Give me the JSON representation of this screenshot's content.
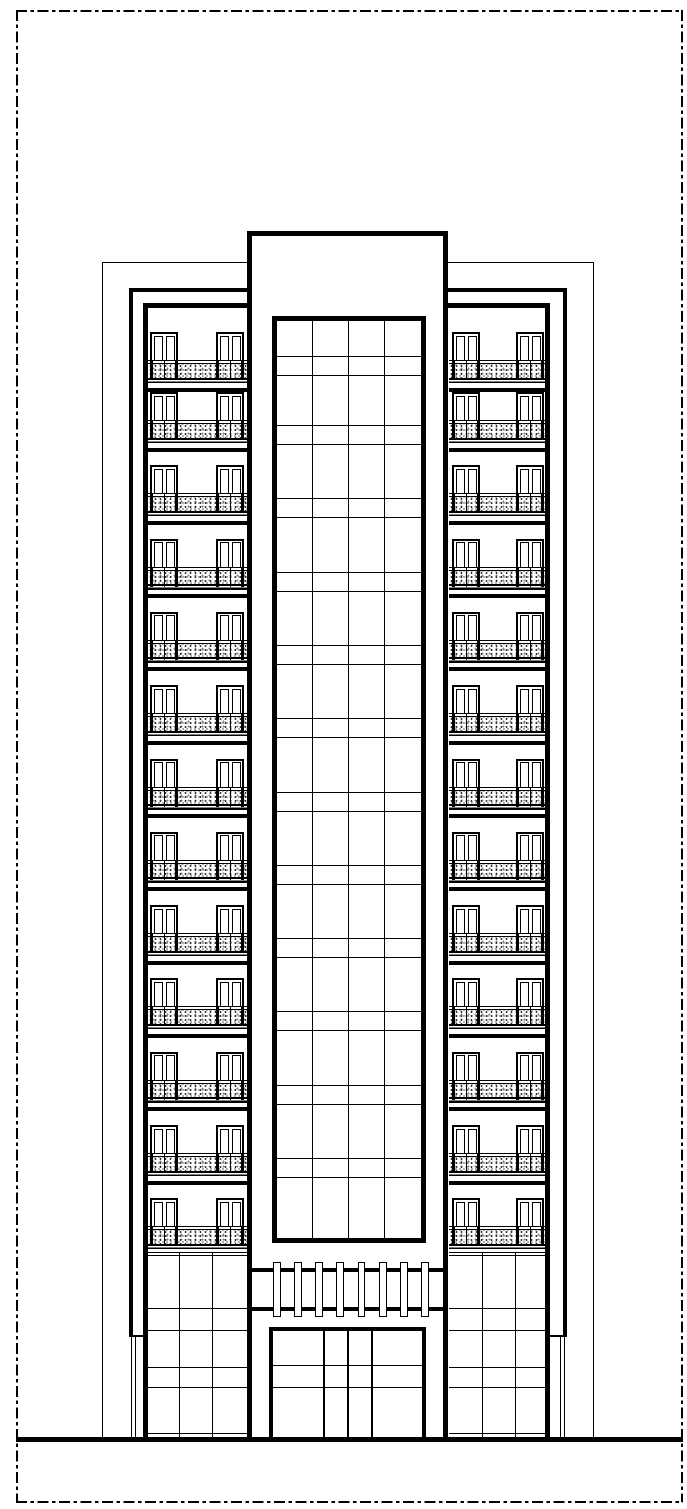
{
  "sheet": {
    "kind": "architectural-elevation-drawing",
    "background": "#ffffff",
    "line_color": "#000000",
    "border_style": "dash-dot"
  },
  "building": {
    "floors": 13,
    "wings": [
      {
        "side": "left",
        "windows_per_floor": 2
      },
      {
        "side": "right",
        "windows_per_floor": 2
      }
    ],
    "window": {
      "leaves": 2
    },
    "balcony": {
      "texture": "stipple",
      "bold_posts": 4,
      "thin_posts": 2
    },
    "curtain_wall": {
      "columns": 4,
      "spandrel_bands": 12
    },
    "podium": {
      "columns": 3,
      "horizontal_lines": 7
    },
    "entrance": {
      "colonnade_posts": 8,
      "door_columns": 4,
      "door_rows": 3
    },
    "ground_line": true
  }
}
